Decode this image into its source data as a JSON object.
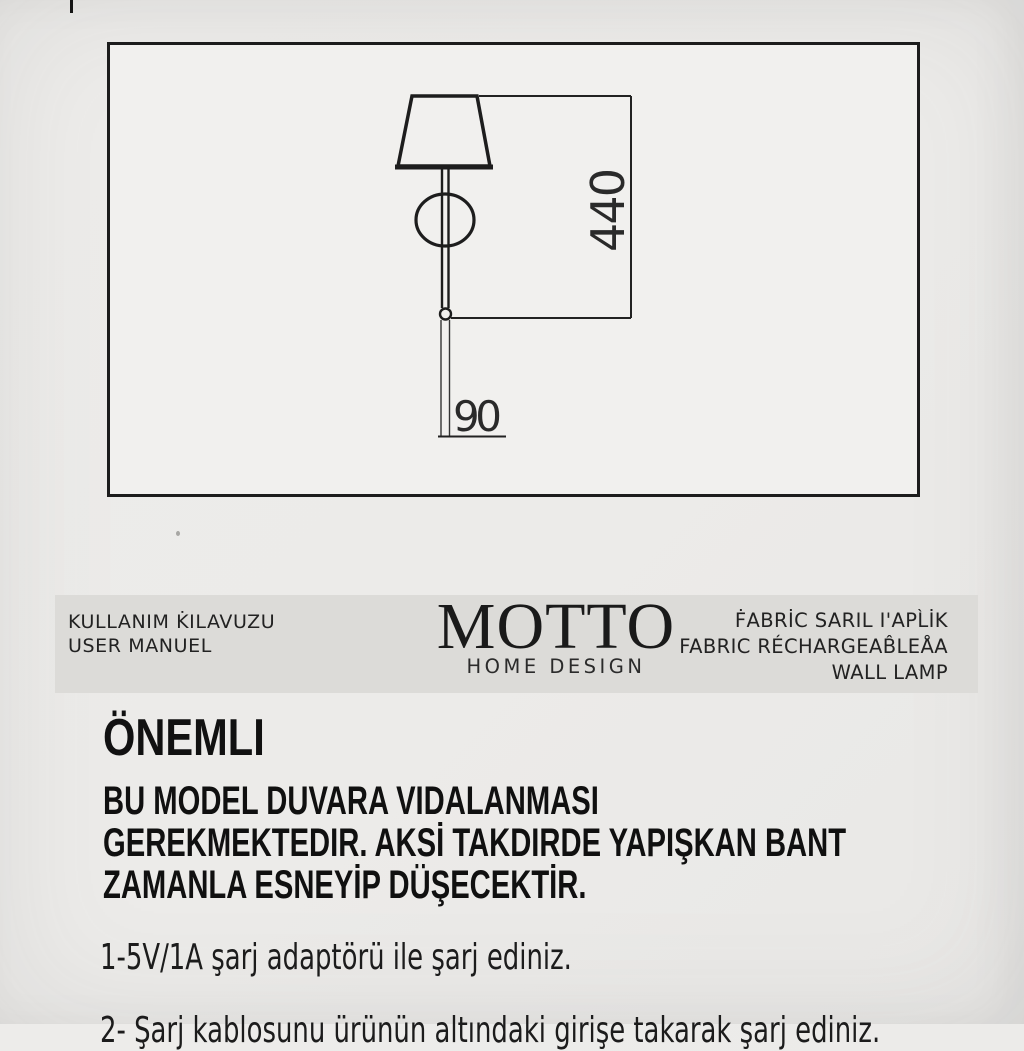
{
  "drawing": {
    "height_label": "440",
    "width_label": "90"
  },
  "header_band": {
    "left": {
      "line1": "KULLANIM K̇ILAVUZU",
      "line2": "USER MANUEL"
    },
    "logo": {
      "name": "MOTTO",
      "tagline": "HOME DESIGN"
    },
    "right": {
      "line1": "ḞABRİC SARIL I'APL̀İK",
      "line2": "FABRIC RÉCHARGEAB̂LEÅA",
      "line3": "WALL LAMP"
    }
  },
  "content": {
    "heading": "ÖNEMLI",
    "warning_lines": [
      "BU MODEL DUVARA VIDALANMASI",
      "GEREKMEKTEDIR. AKSİ TAKDIRDE YAPIŞKAN BANT",
      "ZAMANLA ESNEYİP DÜŞECEKTİR."
    ],
    "instruction_1": "1-5V/1A şarj adaptörü ile şarj ediniz.",
    "instruction_2_clipped": "2- Şarj kablosunu ürünün altındaki girişe takarak şarj ediniz."
  },
  "colors": {
    "page_bg": "#ecebe9",
    "panel_bg": "#f1f0ee",
    "band_bg": "#dcdbd8",
    "ink": "#1d1d1d"
  }
}
